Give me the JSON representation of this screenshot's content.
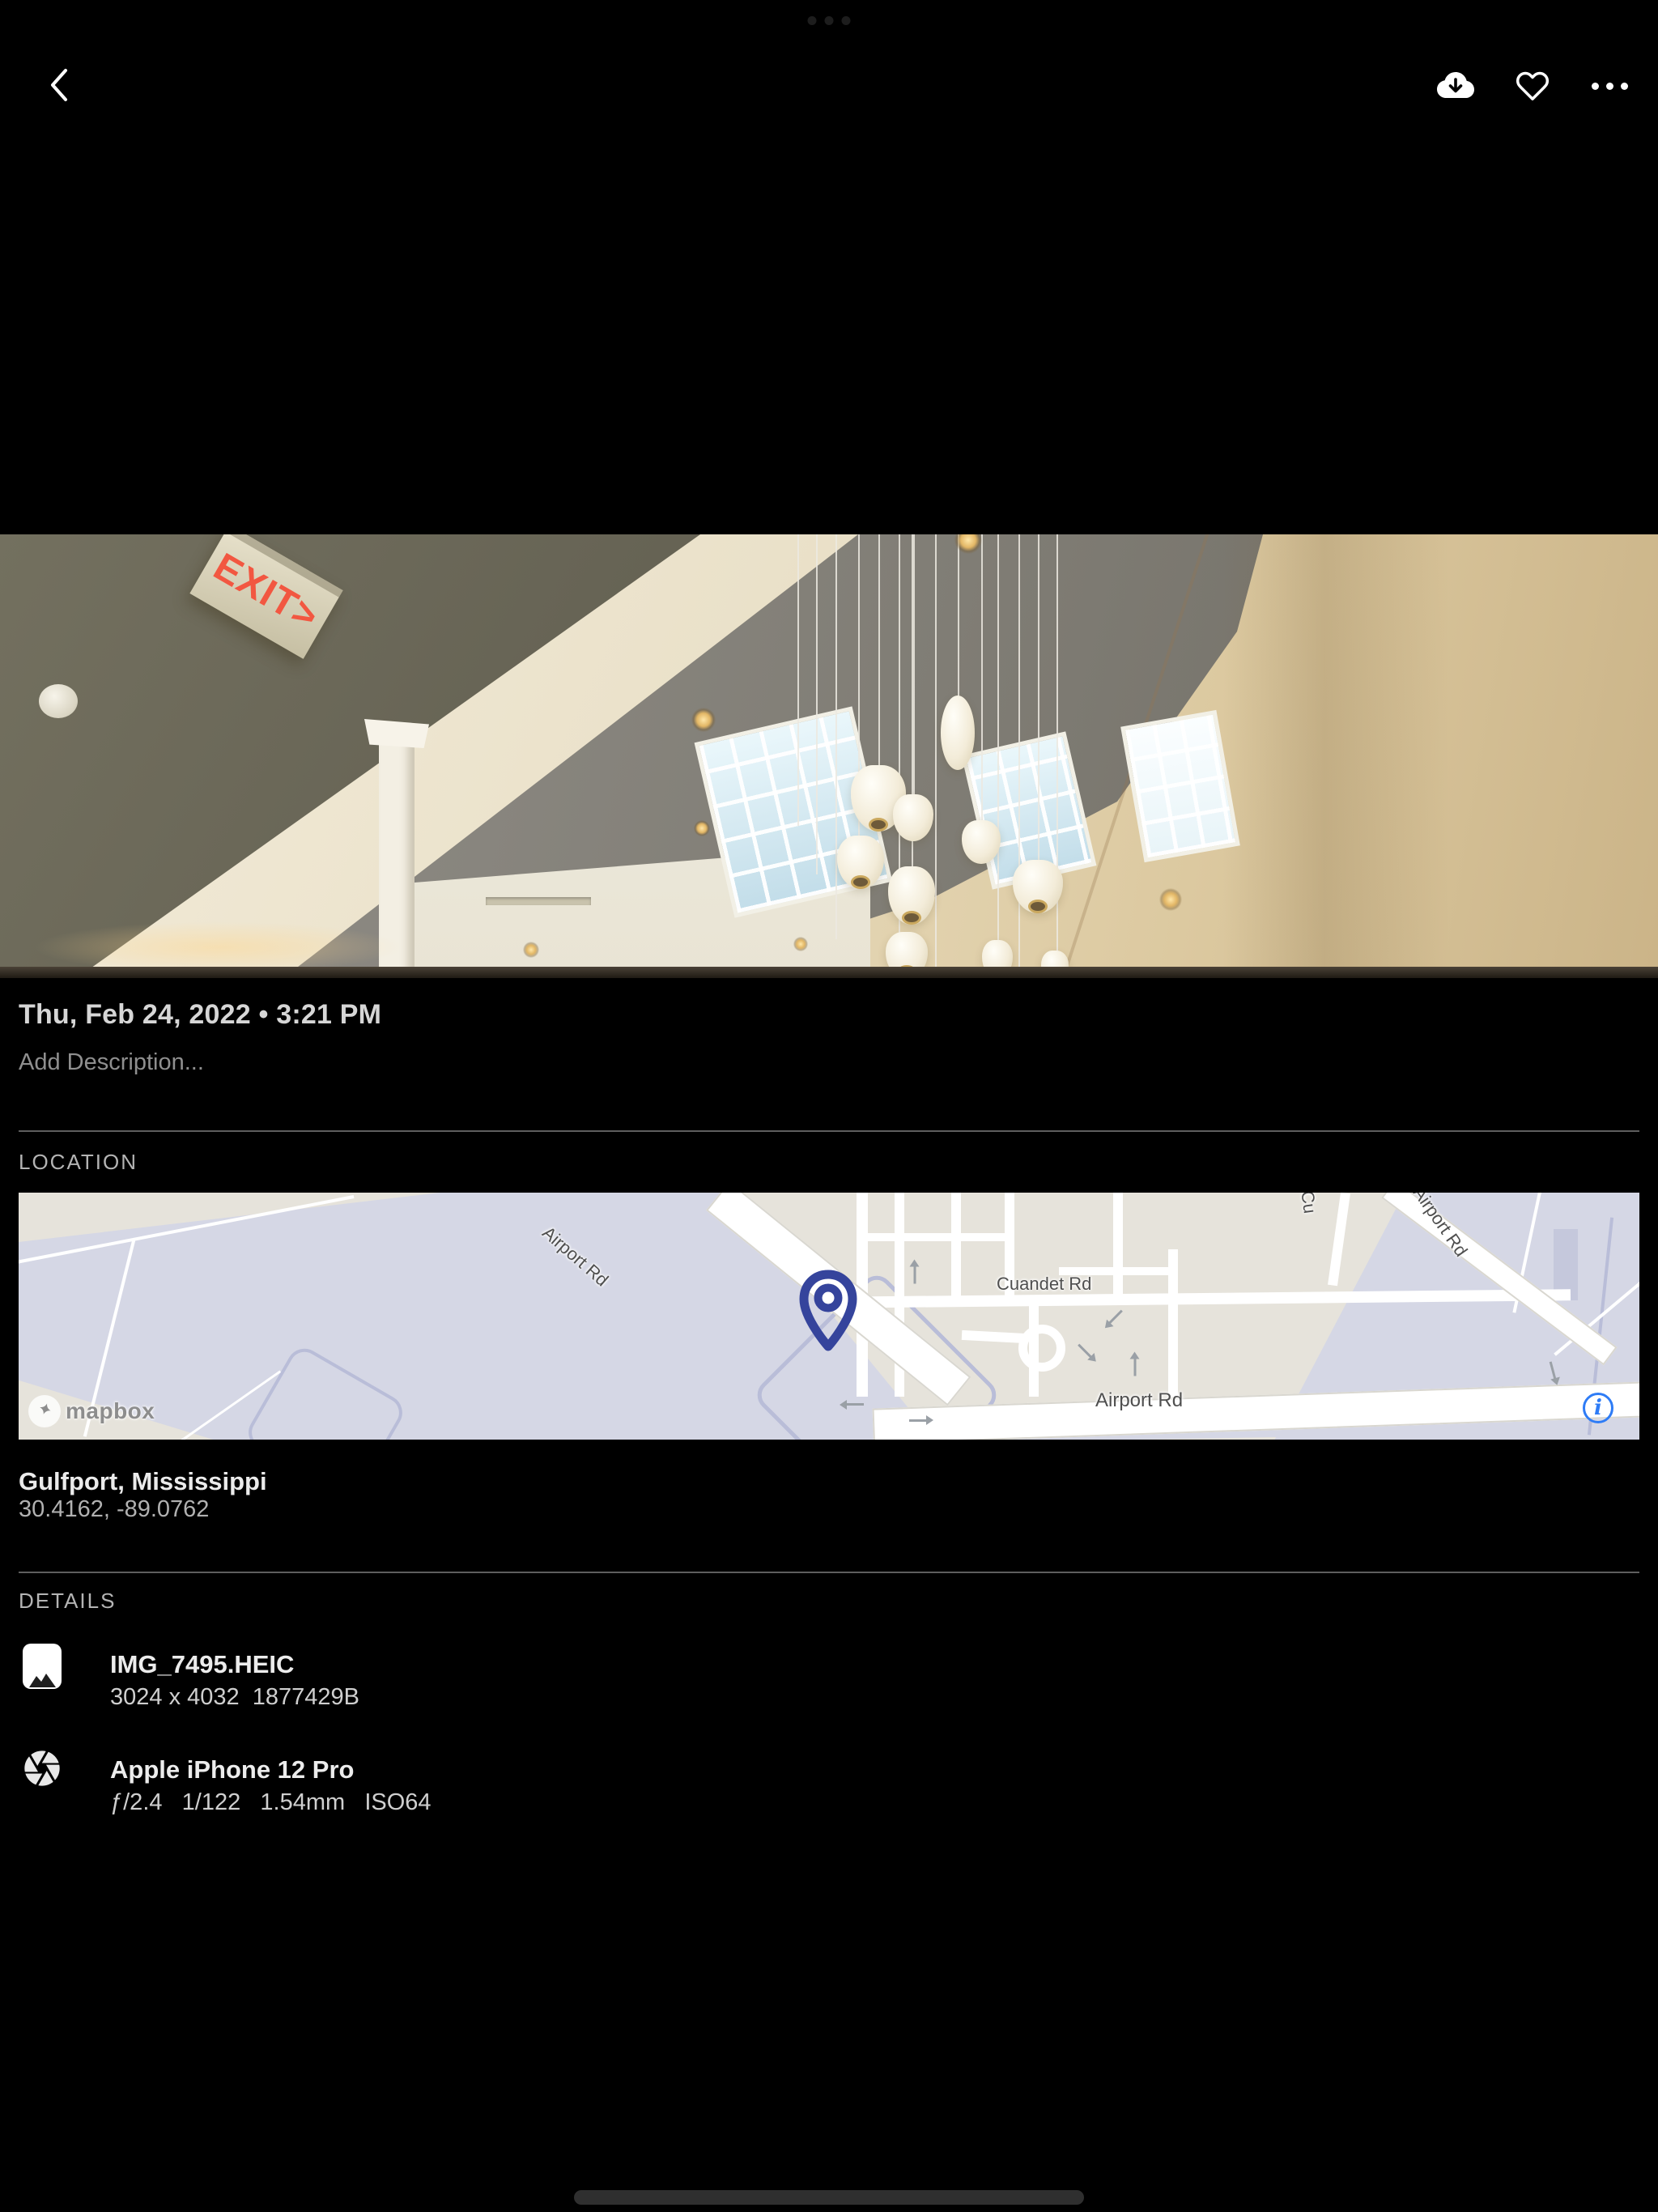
{
  "top_bar": {
    "back_icon": "chevron-left-icon",
    "actions": [
      {
        "name": "download",
        "icon": "cloud-download-icon"
      },
      {
        "name": "favorite",
        "icon": "heart-icon"
      },
      {
        "name": "more",
        "icon": "ellipsis-icon"
      }
    ]
  },
  "photo": {
    "exit_sign": "EXIT>"
  },
  "info": {
    "date_line": "Thu, Feb 24, 2022 • 3:21 PM",
    "description_placeholder": "Add Description..."
  },
  "location": {
    "section_label": "LOCATION",
    "place": "Gulfport, Mississippi",
    "coordinates": "30.4162, -89.0762",
    "map": {
      "labels": {
        "airport_rd_diagonal": "Airport Rd",
        "cuandet_rd": "Cuandet Rd",
        "airport_rd_horizontal": "Airport Rd",
        "airport_rd_upper_right": "Airport Rd",
        "cross_street_partial": "Cu"
      },
      "attribution": "mapbox",
      "info_button": "i",
      "pin_color": "#35449c",
      "info_color": "#2e7cf6"
    }
  },
  "details": {
    "section_label": "DETAILS",
    "items": [
      {
        "icon": "image-file-icon",
        "title": "IMG_7495.HEIC",
        "subtitle": "3024 x 4032  1877429B"
      },
      {
        "icon": "camera-aperture-icon",
        "title": "Apple iPhone 12 Pro",
        "subtitle": "ƒ/2.4   1/122   1.54mm   ISO64"
      }
    ]
  }
}
